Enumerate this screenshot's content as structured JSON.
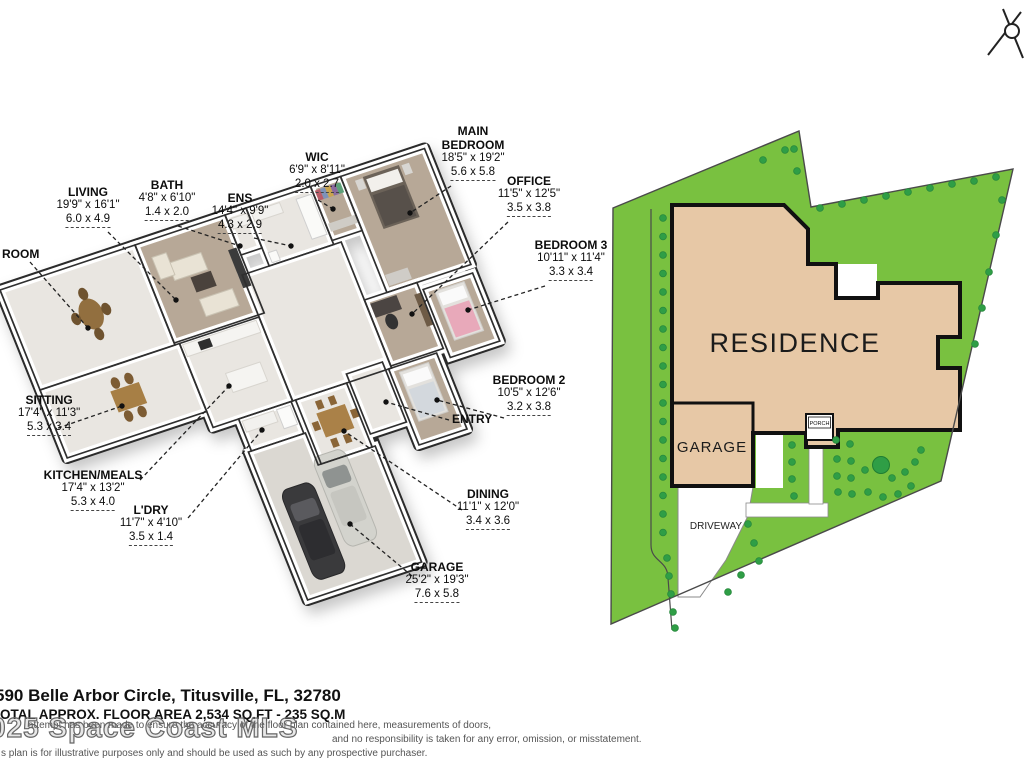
{
  "floor_plan": {
    "labels": [
      {
        "id": "family-room",
        "lines": [
          "ROOM"
        ],
        "ft": "",
        "m": "",
        "x": 2,
        "y": 247,
        "align": "left",
        "leader": [
          30,
          262,
          88,
          328
        ]
      },
      {
        "id": "living",
        "lines": [
          "LIVING"
        ],
        "ft": "19'9\" x 16'1\"",
        "m": "6.0 x 4.9",
        "x": 88,
        "y": 185,
        "align": "center",
        "leader": [
          108,
          232,
          176,
          300
        ]
      },
      {
        "id": "bath",
        "lines": [
          "BATH"
        ],
        "ft": "4'8\" x 6'10\"",
        "m": "1.4 x 2.0",
        "x": 167,
        "y": 178,
        "align": "center",
        "leader": [
          178,
          226,
          240,
          246
        ]
      },
      {
        "id": "ens",
        "lines": [
          "ENS"
        ],
        "ft": "14'4\" x 9'9\"",
        "m": "4.3 x 2.9",
        "x": 240,
        "y": 191,
        "align": "center",
        "leader": [
          254,
          238,
          291,
          246
        ]
      },
      {
        "id": "wic",
        "lines": [
          "WIC"
        ],
        "ft": "6'9\" x 8'11\"",
        "m": "2.0 x 2.7",
        "x": 317,
        "y": 150,
        "align": "center",
        "leader": [
          318,
          200,
          333,
          209
        ]
      },
      {
        "id": "main-bedroom",
        "lines": [
          "MAIN",
          "BEDROOM"
        ],
        "ft": "18'5\" x 19'2\"",
        "m": "5.6 x 5.8",
        "x": 473,
        "y": 124,
        "align": "center",
        "leader": [
          451,
          186,
          410,
          213
        ]
      },
      {
        "id": "office",
        "lines": [
          "OFFICE"
        ],
        "ft": "11'5\" x 12'5\"",
        "m": "3.5 x 3.8",
        "x": 529,
        "y": 174,
        "align": "center",
        "leader": [
          508,
          222,
          412,
          314
        ]
      },
      {
        "id": "bedroom-3",
        "lines": [
          "BEDROOM 3"
        ],
        "ft": "10'11\" x 11'4\"",
        "m": "3.3 x 3.4",
        "x": 571,
        "y": 238,
        "align": "center",
        "leader": [
          545,
          286,
          468,
          310
        ]
      },
      {
        "id": "bedroom-2",
        "lines": [
          "BEDROOM 2"
        ],
        "ft": "10'5\" x 12'6\"",
        "m": "3.2 x 3.8",
        "x": 529,
        "y": 373,
        "align": "center",
        "leader": [
          504,
          418,
          437,
          400
        ]
      },
      {
        "id": "entry",
        "lines": [
          "ENTRY"
        ],
        "ft": "",
        "m": "",
        "x": 452,
        "y": 412,
        "align": "left",
        "leader": [
          449,
          420,
          386,
          402
        ]
      },
      {
        "id": "dining",
        "lines": [
          "DINING"
        ],
        "ft": "11'1\" x 12'0\"",
        "m": "3.4 x 3.6",
        "x": 488,
        "y": 487,
        "align": "center",
        "leader": [
          462,
          510,
          344,
          431
        ]
      },
      {
        "id": "garage",
        "lines": [
          "GARAGE"
        ],
        "ft": "25'2\" x 19'3\"",
        "m": "7.6 x 5.8",
        "x": 437,
        "y": 560,
        "align": "center",
        "leader": [
          412,
          576,
          350,
          524
        ]
      },
      {
        "id": "sitting",
        "lines": [
          "SITTING"
        ],
        "ft": "17'4\" x 11'3\"",
        "m": "5.3 x 3.4",
        "x": 18,
        "y": 393,
        "align": "left",
        "leader": [
          58,
          428,
          122,
          406
        ]
      },
      {
        "id": "kitchen-meals",
        "lines": [
          "KITCHEN/MEALS"
        ],
        "ft": "17'4\" x 13'2\"",
        "m": "5.3 x 4.0",
        "x": 93,
        "y": 468,
        "align": "center",
        "leader": [
          140,
          480,
          229,
          386
        ]
      },
      {
        "id": "ldry",
        "lines": [
          "L'DRY"
        ],
        "ft": "11'7\" x 4'10\"",
        "m": "3.5 x 1.4",
        "x": 151,
        "y": 503,
        "align": "center",
        "leader": [
          188,
          518,
          262,
          430
        ]
      }
    ]
  },
  "site_plan": {
    "residence_label": "RESIDENCE",
    "garage_label": "GARAGE",
    "porch_label": "PORCH",
    "driveway_label": "DRIVEWAY",
    "lot_color": "#79c140",
    "tree_color": "#2f9e46",
    "residence_color": "#e7c8a6"
  },
  "footer": {
    "address": "590 Belle Arbor Circle, Titusville, FL, 32780",
    "area": "OTAL APPROX. FLOOR AREA 2,534 SQ.FT - 235 SQ.M",
    "watermark": "025 Space Coast MLS",
    "disclaimer1": "attempt has been made to ensure the accuracy of the floor plan contained here, measurements of doors,",
    "disclaimer2": "and no responsibility is taken for any error, omission, or misstatement.",
    "disclaimer3": "s plan is for illustrative purposes only and should be used as such by any prospective purchaser."
  }
}
